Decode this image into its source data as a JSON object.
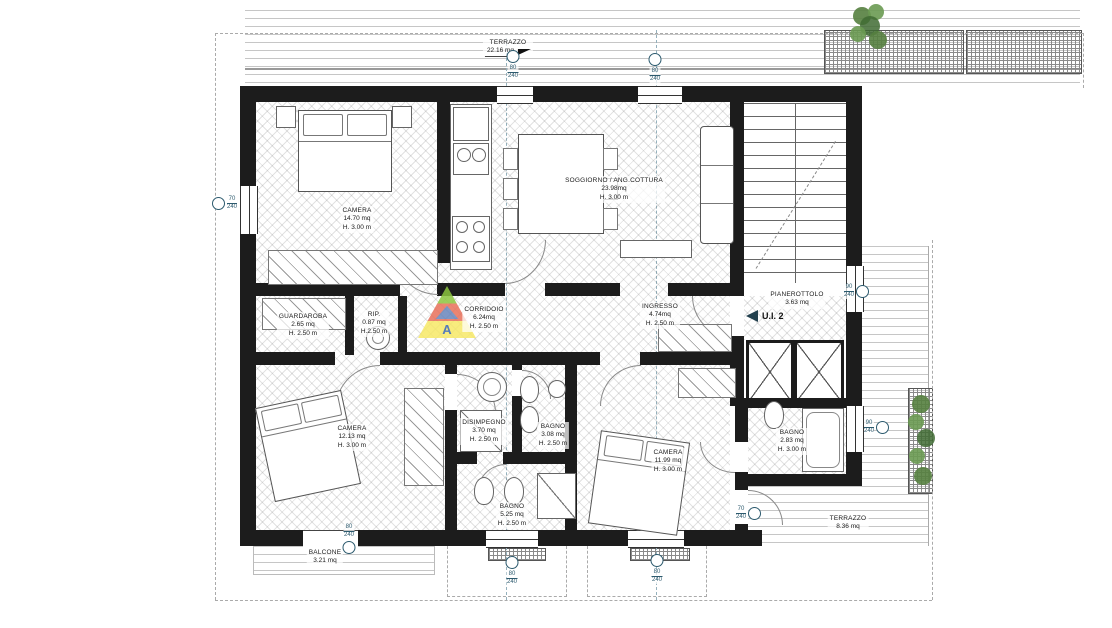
{
  "drawing": {
    "type": "floor-plan",
    "unit_label": "U.I. 2"
  },
  "rooms": [
    {
      "name": "CAMERA",
      "area": "14.70 mq",
      "height": "H. 3.00 m"
    },
    {
      "name": "SOGGIORNO / ANG.COTTURA",
      "area": "23.98mq",
      "height": "H. 3.00 m"
    },
    {
      "name": "PIANEROTTOLO",
      "area": "3.63 mq",
      "height": ""
    },
    {
      "name": "GUARDAROBA",
      "area": "2.65 mq",
      "height": "H. 2.50 m"
    },
    {
      "name": "RIP.",
      "area": "0.87 mq",
      "height": "H.2.50 m"
    },
    {
      "name": "CORRIDOIO",
      "area": "6.24mq",
      "height": "H. 2.50 m"
    },
    {
      "name": "INGRESSO",
      "area": "4.74mq",
      "height": "H. 2.50 m"
    },
    {
      "name": "CAMERA",
      "area": "12.13 mq",
      "height": "H. 3.00 m"
    },
    {
      "name": "DISIMPEGNO",
      "area": "3.70 mq",
      "height": "H. 2.50 m"
    },
    {
      "name": "BAGNO",
      "area": "3.08 mq",
      "height": "H. 2.50 m"
    },
    {
      "name": "CAMERA",
      "area": "11.99 mq",
      "height": "H. 3.00 m"
    },
    {
      "name": "BAGNO",
      "area": "2.83 mq",
      "height": "H. 3.00 m"
    },
    {
      "name": "BAGNO",
      "area": "5.25 mq",
      "height": "H. 2.50 m"
    },
    {
      "name": "TERRAZZO",
      "area": "8.36 mq",
      "height": ""
    },
    {
      "name": "BALCONE",
      "area": "3.21 mq",
      "height": ""
    },
    {
      "name": "TERRAZZO",
      "area": "22.16 mq",
      "height": ""
    }
  ],
  "markers": [
    {
      "w": "80",
      "h": "240"
    },
    {
      "w": "80",
      "h": "240"
    },
    {
      "w": "70",
      "h": "240"
    },
    {
      "w": "90",
      "h": "240"
    },
    {
      "w": "90",
      "h": "240"
    },
    {
      "w": "70",
      "h": "240"
    },
    {
      "w": "80",
      "h": "240"
    },
    {
      "w": "80",
      "h": "240"
    },
    {
      "w": "80",
      "h": "240"
    }
  ],
  "watermark": {
    "letter": "A"
  },
  "colors": {
    "wall": "#1c1c1c",
    "marker": "#2c5a6e",
    "plant": "#55803f",
    "watermark_green": "#8cc63f",
    "watermark_red": "#e8705a",
    "watermark_yellow": "#f7e967",
    "watermark_blue": "#3a67b0"
  }
}
